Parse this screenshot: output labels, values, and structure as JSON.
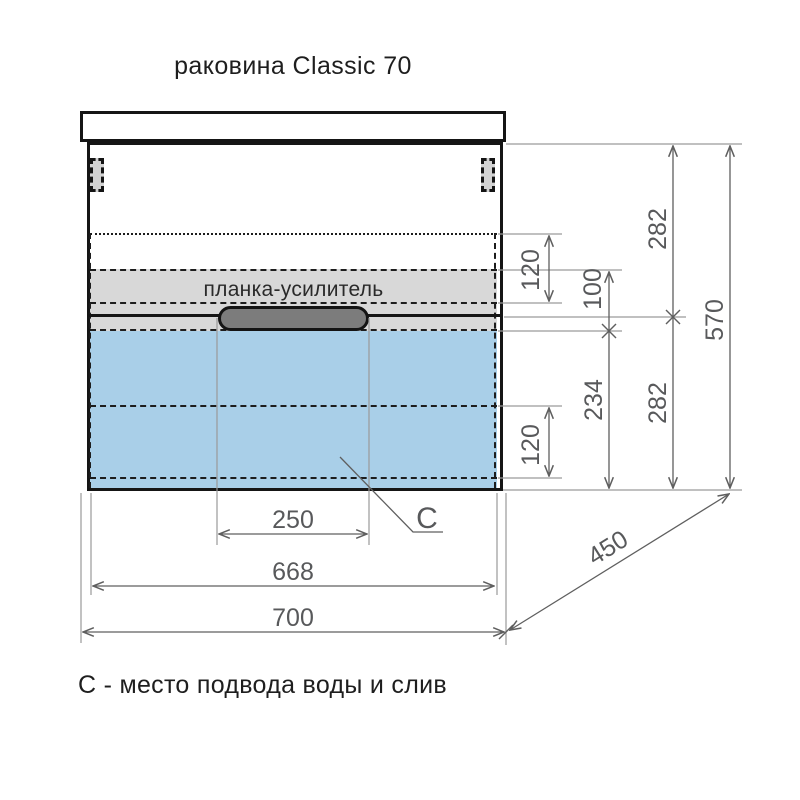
{
  "title": "раковина Classic 70",
  "legend": "С - место подвода воды и слив",
  "cabinet": {
    "band_label": "планка-усилитель",
    "point_label": "C"
  },
  "dims": {
    "h282_upper": "282",
    "h570": "570",
    "h120_upper": "120",
    "h100": "100",
    "h234": "234",
    "h282_lower": "282",
    "h120_lower": "120",
    "w250": "250",
    "w668": "668",
    "w700": "700",
    "d450": "450"
  },
  "colors": {
    "drawer_highlight": "#a9cfe8",
    "band_fill": "#d8d8d8",
    "handle_fill": "#7c7c7c",
    "outline": "#151515",
    "dimension_line": "#5f5f5f",
    "dimension_text": "#58595b"
  }
}
